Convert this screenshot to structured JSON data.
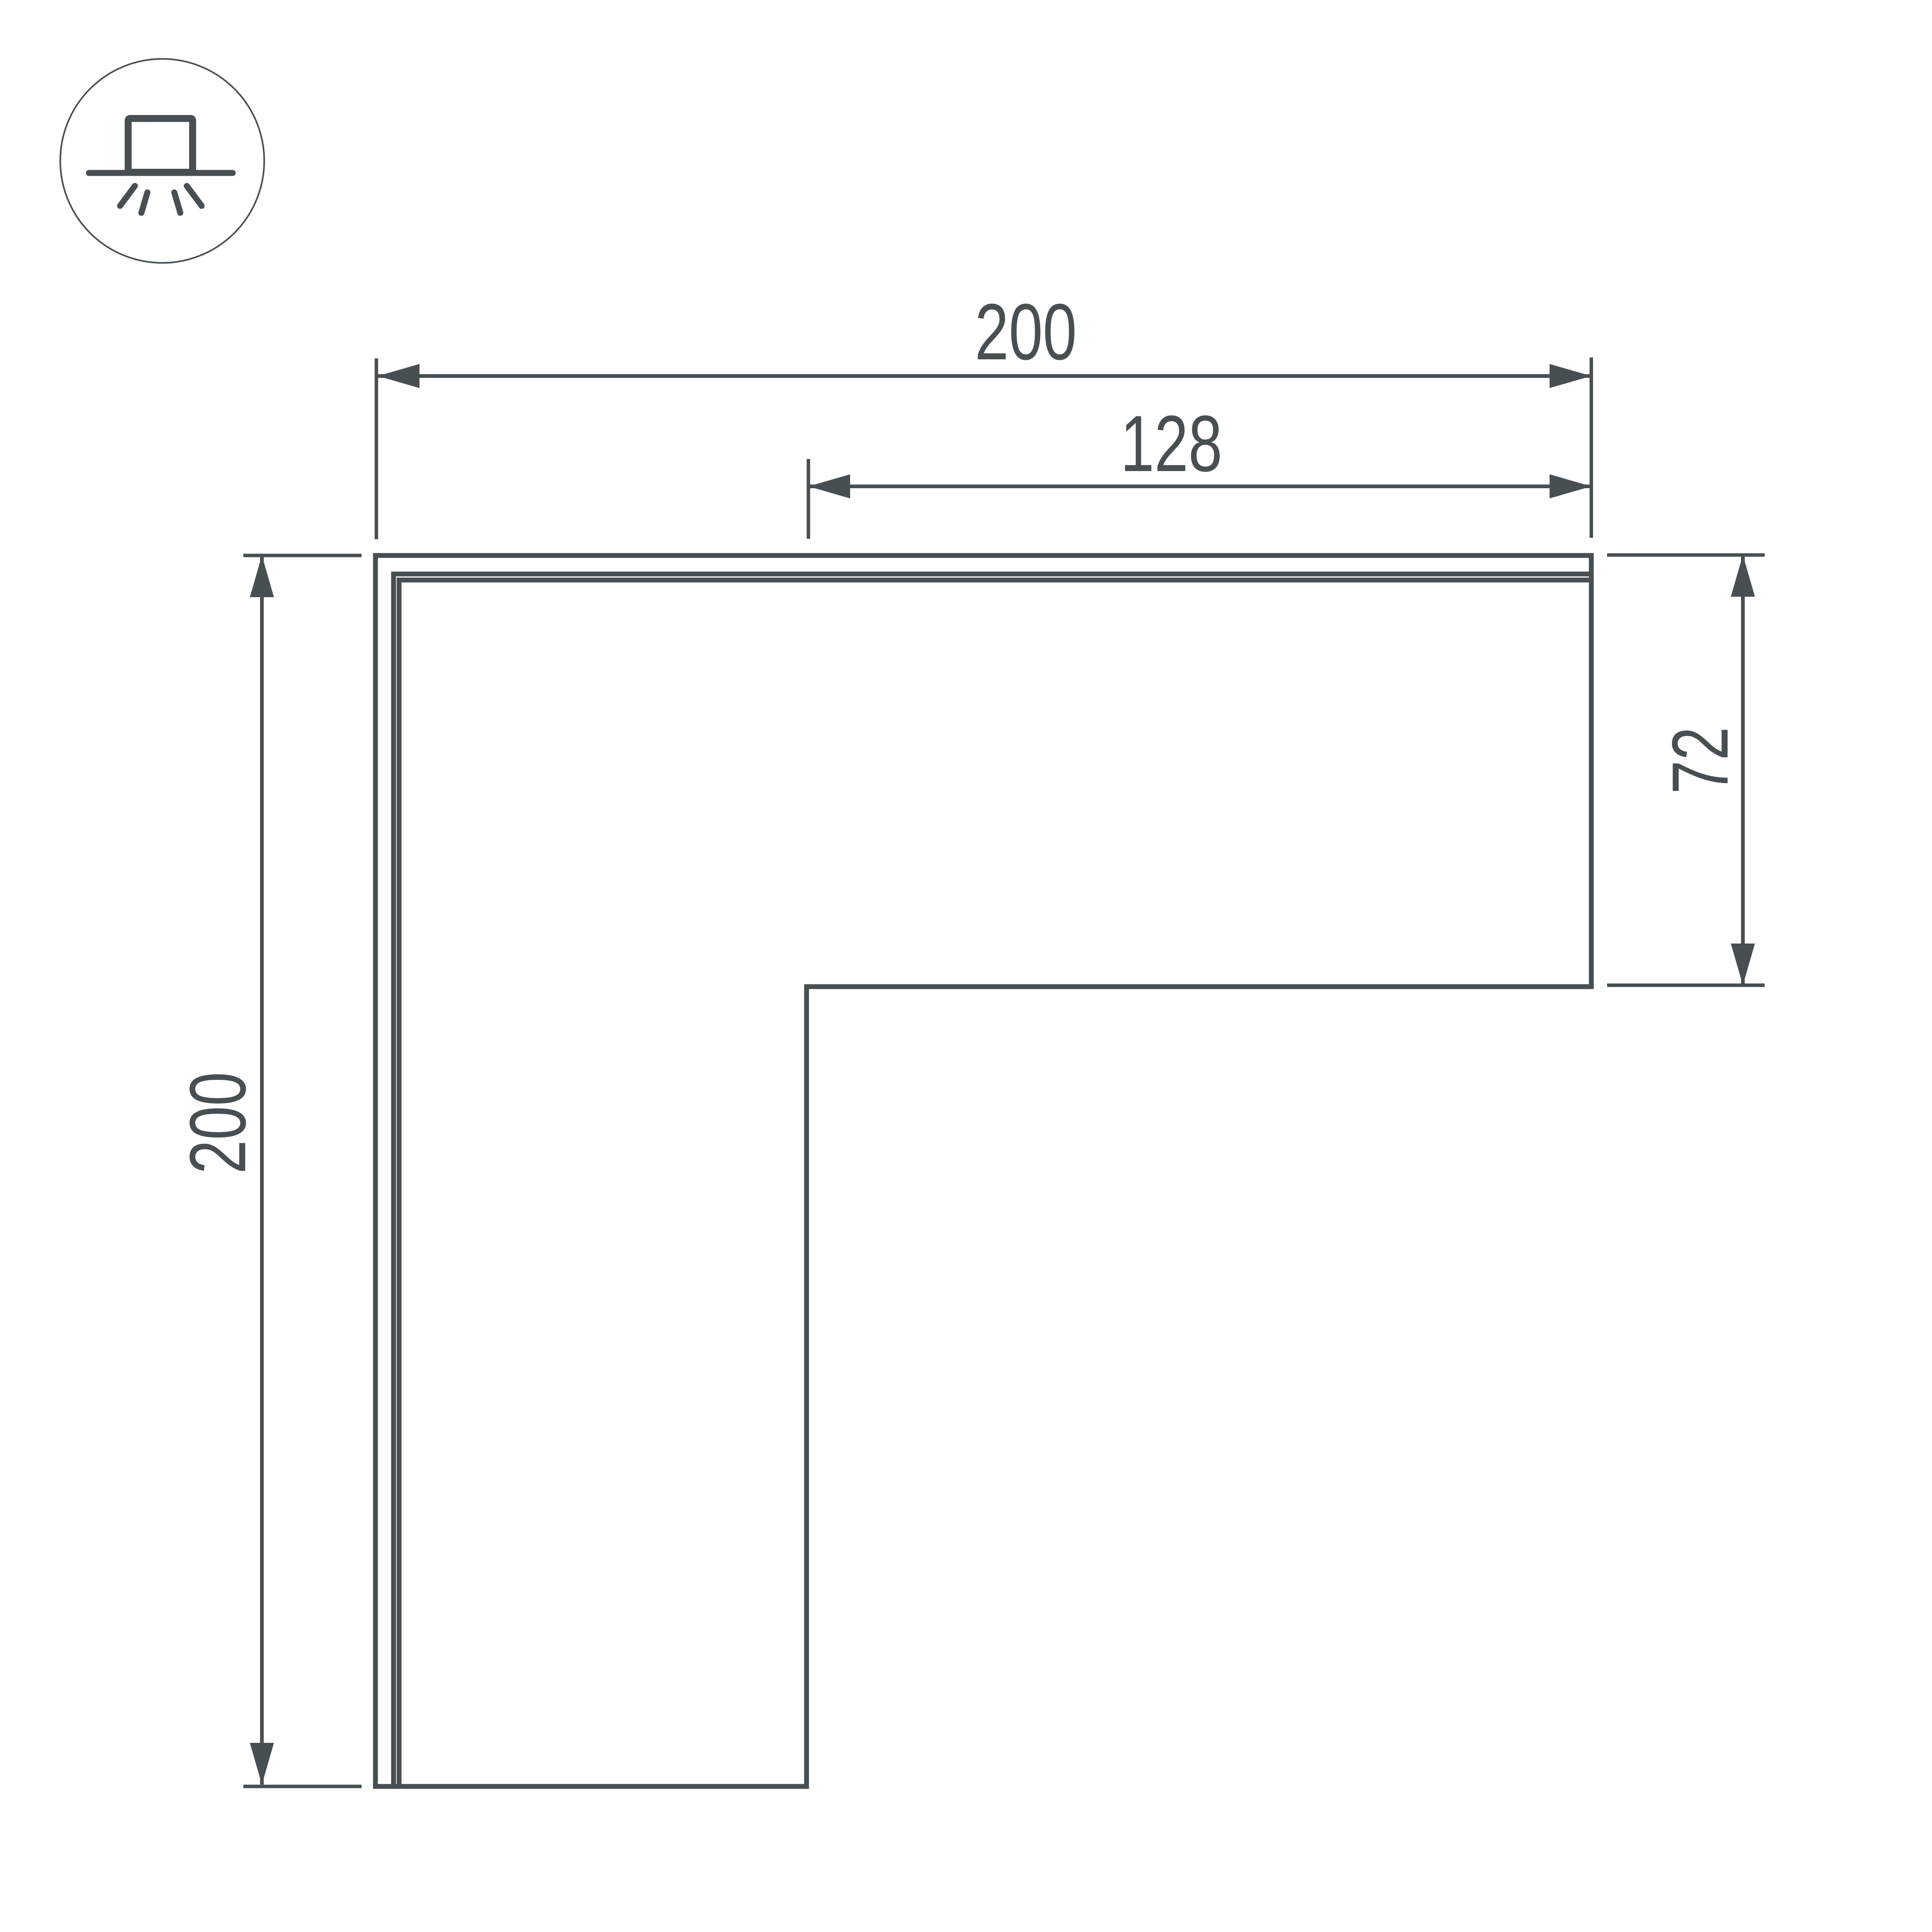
{
  "drawing": {
    "background": "#ffffff",
    "line_color": "#484f53",
    "labels": {
      "top_width": "200",
      "inner_width": "128",
      "left_height": "200",
      "arm_height": "72"
    },
    "icon": {
      "name": "surface-mounted-luminaire",
      "parts": [
        "circle-outline",
        "fixture-box",
        "mounting-surface-line",
        "light-rays"
      ]
    },
    "part": {
      "name": "L-shaped corner connector",
      "shape": "L"
    }
  }
}
